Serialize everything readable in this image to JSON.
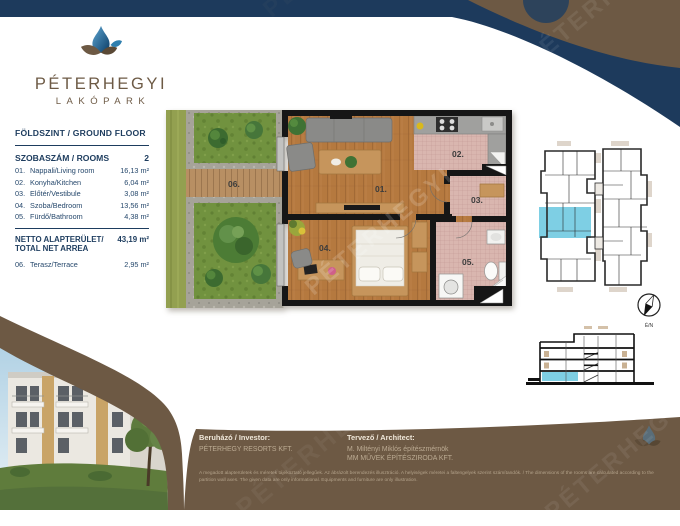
{
  "brand": {
    "name_line1": "PÉTERHEGYI",
    "name_line2": "LAKÓPARK",
    "watermark_text": "PÉTERHEGYI"
  },
  "panel": {
    "floor_header": "FÖLDSZINT / GROUND FLOOR",
    "rooms_header_label": "SZOBASZÁM / ROOMS",
    "rooms_header_value": "2",
    "rows": [
      {
        "num": "01.",
        "name": "Nappali/Living room",
        "area": "16,13 m²"
      },
      {
        "num": "02.",
        "name": "Konyha/Kitchen",
        "area": "6,04 m²"
      },
      {
        "num": "03.",
        "name": "Előtér/Vestibule",
        "area": "3,08 m²"
      },
      {
        "num": "04.",
        "name": "Szoba/Bedroom",
        "area": "13,56 m²"
      },
      {
        "num": "05.",
        "name": "Fürdő/Bathroom",
        "area": "4,38 m²"
      }
    ],
    "total_label_line1": "NETTO ALAPTERÜLET/",
    "total_label_line2": "TOTAL NET ARREA",
    "total_value": "43,19 m²",
    "terrace_row": {
      "num": "06.",
      "name": "Terasz/Terrace",
      "area": "2,95 m²"
    }
  },
  "plan": {
    "labels": {
      "living": "01.",
      "kitchen": "02.",
      "vestibule": "03.",
      "bedroom": "04.",
      "bathroom": "05.",
      "terrace": "06."
    }
  },
  "compass": {
    "label": "É/N"
  },
  "footer": {
    "investor_label": "Beruházó / Investor:",
    "investor_name": "PÉTERHEGY RESORTS KFT.",
    "architect_label": "Tervező / Architect:",
    "architect_name_line1": "M. Miltényi Miklós építészmérnök",
    "architect_name_line2": "MM MŰVEK ÉPÍTÉSZIRODA KFT.",
    "disclaimer": "A megadott alapterületek és méretek tájékoztató jellegűek. Az ábrázolt berendezés illusztráció. A helyiségek méretei a faltengelyek szerint számítandók. / The dimensions of the rooms are calculated according to the partition wall axes. The given data are only informational. Equipments and furniture are only illustration."
  },
  "colors": {
    "navy": "#1d3a5c",
    "brown": "#6d5944",
    "highlight_blue": "#7ecfe4"
  }
}
